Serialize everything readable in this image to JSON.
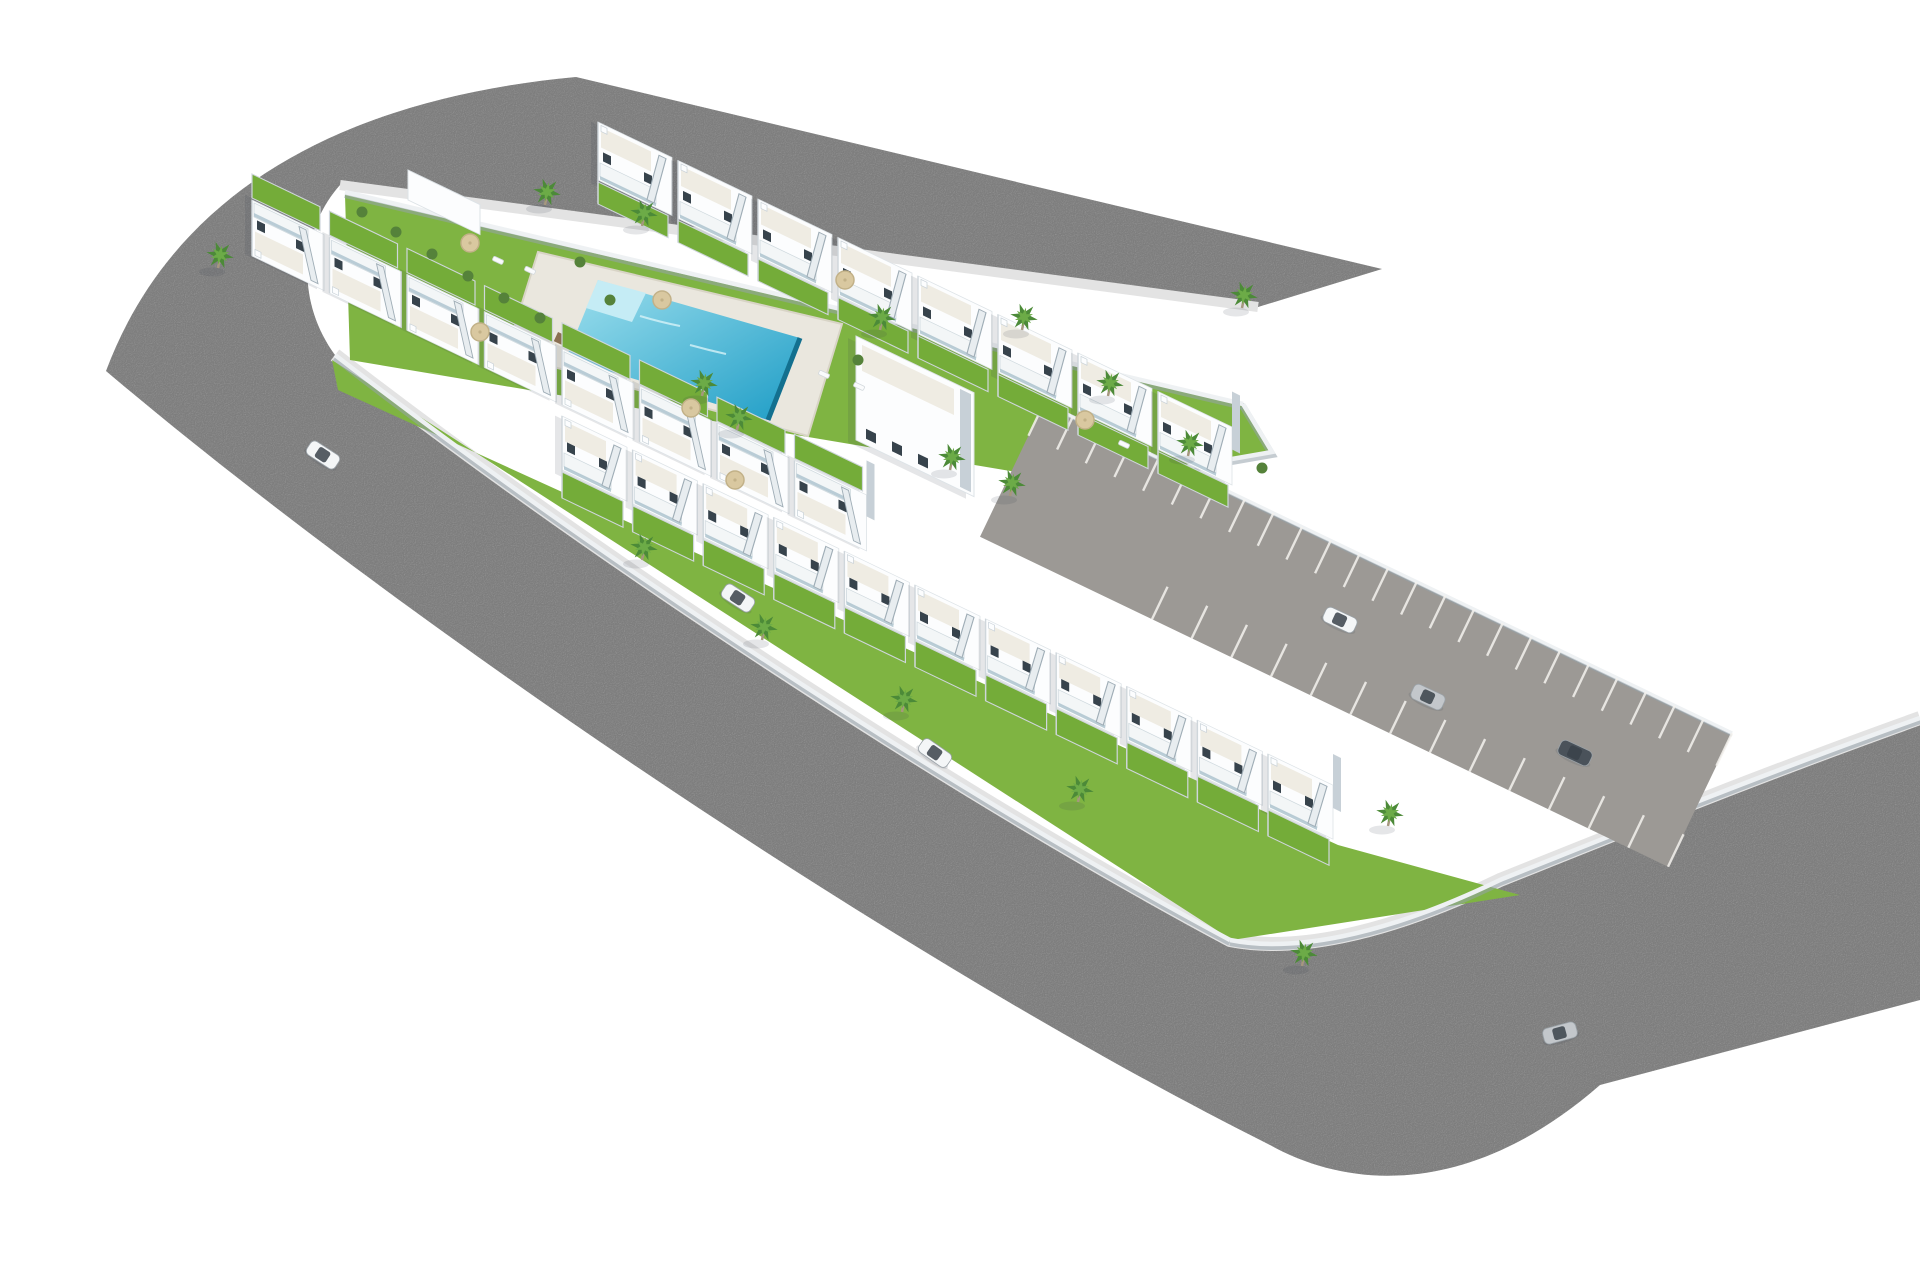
{
  "image": {
    "width": 1920,
    "height": 1280,
    "type": "3d-architectural-aerial-render",
    "subject": "L-shaped residential townhouse development with communal pool garden, perimeter roads, inner parking lane and cars"
  },
  "palette": {
    "background": "#ffffff",
    "road": "#a8a8a8",
    "road_texture": "#9e9e9e",
    "sidewalk": "#e3e3e3",
    "curb": "#f6f6f6",
    "parking_surface": "#9c9995",
    "parking_line": "#f5f3ef",
    "lawn": "#7fb442",
    "garden": "#74ac39",
    "hedge": "#55823a",
    "wall": "#eef1f3",
    "wall_shadow": "#96a3ac",
    "house_white": "#fcfdfe",
    "house_edge": "#dde3e7",
    "house_side": "#c7d0d7",
    "roof_terrace": "#efece3",
    "window": "#37434c",
    "glass": "#b3c8d2",
    "stair_rail": "#9fadb6",
    "stair_fill": "#e8edf0",
    "divider": "#cfd6db",
    "pool_deck": "#eae7de",
    "pool_deck_edge": "#d8d4c6",
    "pool_shallow": "#9fe0ee",
    "pool_deep": "#1e9dc6",
    "pool_rim": "#13708f",
    "pool_steps": "#c5ecf5",
    "wood_steps": "#8a6f52",
    "palm_dark": "#4c8a38",
    "palm_light": "#6cab47",
    "trunk": "#a6977f",
    "parasol": "#d9c8a0",
    "parasol_edge": "#c2b188",
    "lounger": "#fafbfc",
    "car_white": "#f4f6f7",
    "car_silver": "#c3c7cb",
    "car_dark": "#4a525a",
    "car_glass": "#39424a",
    "shadow": "rgba(55,65,75,0.13)"
  },
  "road": {
    "surface_path": "M1382,269 L576,77 C330,100 170,200 106,371 C400,620 900,960 1270,1145 C1360,1195 1480,1190 1600,1085 L1920,1000 L1920,718 C1760,775 1600,840 1500,880 C1380,938 1290,952 1230,940 C950,790 600,560 335,355 C295,300 300,230 340,185 L1258,307 Z",
    "sidewalk_inner_path": "M335,355 C600,560 950,790 1230,940 C1290,952 1380,938 1500,880 C1600,840 1760,775 1920,718",
    "sidewalk_top_path": "M340,185 L1258,307"
  },
  "walls": [
    {
      "name": "southwest-perimeter-wall",
      "path": "M335,355 C600,560 950,790 1230,940"
    },
    {
      "name": "northwest-perimeter-wall",
      "path": "M345,192 L1243,404"
    },
    {
      "name": "right-stub-perimeter-wall",
      "path": "M1230,940 C1290,952 1380,938 1500,880 C1600,840 1760,775 1920,718"
    },
    {
      "name": "upper-parcel-right-wall",
      "path": "M1243,404 L1272,452 L1088,484"
    }
  ],
  "lawns": [
    {
      "name": "communal-garden-lawn",
      "points": [
        [
          345,
          195
        ],
        [
          1243,
          405
        ],
        [
          1272,
          452
        ],
        [
          1088,
          484
        ],
        [
          350,
          360
        ]
      ]
    },
    {
      "name": "street-row-gardens-lawn",
      "points": [
        [
          338,
          390
        ],
        [
          1338,
          845
        ],
        [
          1520,
          895
        ],
        [
          1232,
          940
        ],
        [
          332,
          360
        ]
      ]
    }
  ],
  "pool": {
    "deck": [
      [
        538,
        252
      ],
      [
        842,
        324
      ],
      [
        808,
        436
      ],
      [
        506,
        354
      ]
    ],
    "water": [
      [
        598,
        280
      ],
      [
        800,
        338
      ],
      [
        768,
        420
      ],
      [
        566,
        358
      ]
    ],
    "steps": [
      [
        598,
        280
      ],
      [
        646,
        293
      ],
      [
        632,
        322
      ],
      [
        586,
        308
      ]
    ],
    "rim": [
      [
        800,
        338
      ],
      [
        768,
        420
      ]
    ],
    "wood_steps": [
      [
        558,
        332
      ],
      [
        860,
        352
      ]
    ]
  },
  "pavilion": {
    "name": "garden-pavilion",
    "x": 408,
    "y": 170,
    "w": 72,
    "d": 30
  },
  "clubhouse": {
    "name": "two-storey-garden-block",
    "x": 856,
    "y": 336,
    "w": 118,
    "d": 104
  },
  "shear": 0.48,
  "rows": [
    {
      "name": "north-house-row",
      "facing": "sw",
      "units": 8,
      "start": [
        598,
        180
      ],
      "step": [
        80,
        38.5
      ],
      "unit_w": 74,
      "house_depth": 58,
      "garden_depth": 22
    },
    {
      "name": "garden-house-row",
      "facing": "ne",
      "units": 8,
      "start": [
        252,
        256
      ],
      "step": [
        77.5,
        37.2
      ],
      "unit_w": 72,
      "house_depth": 56,
      "garden_depth": 24
    },
    {
      "name": "street-house-row",
      "facing": "sw",
      "units": 11,
      "start": [
        562,
        470
      ],
      "step": [
        70.6,
        33.8
      ],
      "unit_w": 65,
      "house_depth": 54,
      "garden_depth": 26
    }
  ],
  "parking": {
    "a": [
      1012,
      470
    ],
    "b": [
      1700,
      800
    ],
    "lane_half_width": 38,
    "bay_depth": 36,
    "bays_upper": 24,
    "bays_lower": 13,
    "lower_bays_from": 0.25
  },
  "cars": [
    {
      "name": "white-car-west-road-upper",
      "color": "white",
      "x": 323,
      "y": 455,
      "angle": 33
    },
    {
      "name": "white-car-west-road-middle",
      "color": "white",
      "x": 738,
      "y": 598,
      "angle": 33
    },
    {
      "name": "white-car-west-road-lower",
      "color": "white",
      "x": 935,
      "y": 753,
      "angle": 35
    },
    {
      "name": "silver-car-southeast-road",
      "color": "silver",
      "x": 1560,
      "y": 1033,
      "angle": -15
    },
    {
      "name": "white-van-parking-lane",
      "color": "white",
      "x": 1340,
      "y": 620,
      "angle": 25
    },
    {
      "name": "silver-car-parking-lane",
      "color": "silver",
      "x": 1428,
      "y": 697,
      "angle": 25
    },
    {
      "name": "dark-car-parking-lane",
      "color": "dark",
      "x": 1575,
      "y": 753,
      "angle": 25
    }
  ],
  "palms": [
    [
      218,
      268
    ],
    [
      545,
      205
    ],
    [
      642,
      226
    ],
    [
      702,
      396
    ],
    [
      737,
      430
    ],
    [
      1022,
      330
    ],
    [
      1108,
      396
    ],
    [
      1188,
      456
    ],
    [
      880,
      330
    ],
    [
      950,
      470
    ],
    [
      1010,
      496
    ],
    [
      642,
      560
    ],
    [
      762,
      640
    ],
    [
      902,
      712
    ],
    [
      1078,
      802
    ],
    [
      1388,
      826
    ],
    [
      1302,
      966
    ],
    [
      1242,
      308
    ]
  ],
  "parasols": [
    [
      470,
      243
    ],
    [
      662,
      300
    ],
    [
      845,
      280
    ],
    [
      691,
      408
    ],
    [
      1085,
      420
    ],
    [
      480,
      332
    ],
    [
      735,
      480
    ]
  ],
  "loungers": [
    [
      494,
      256
    ],
    [
      526,
      266
    ],
    [
      820,
      370
    ],
    [
      855,
      382
    ],
    [
      1120,
      440
    ]
  ],
  "bushes": [
    [
      362,
      212
    ],
    [
      396,
      232
    ],
    [
      432,
      254
    ],
    [
      468,
      276
    ],
    [
      504,
      298
    ],
    [
      540,
      318
    ],
    [
      1262,
      468
    ],
    [
      858,
      360
    ],
    [
      610,
      300
    ],
    [
      580,
      262
    ]
  ]
}
